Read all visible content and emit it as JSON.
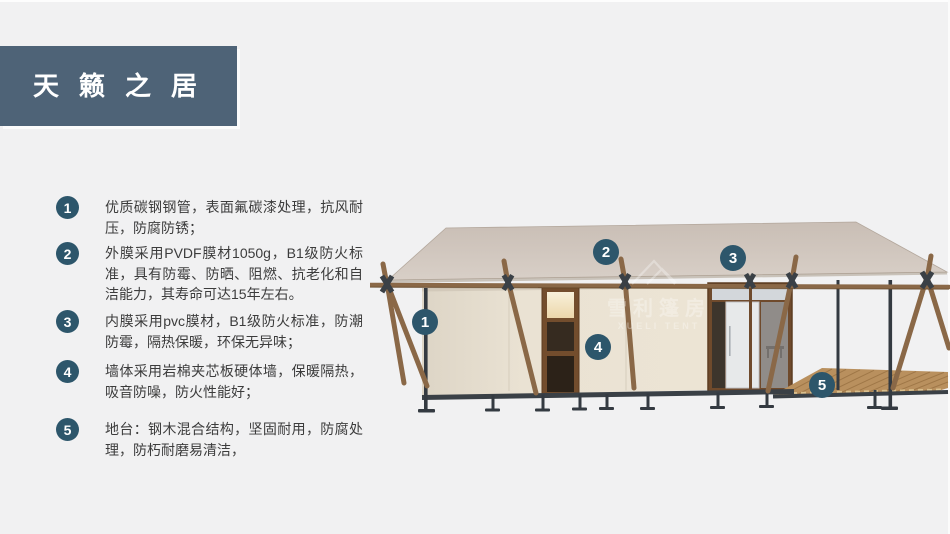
{
  "theme": {
    "background": "#f1f1f2",
    "title_block_color": "#4e6377",
    "badge_color": "#2d566b",
    "roof_color": "#cec3ba",
    "wall_color": "#e9e1d2",
    "wood_color": "#8a6847"
  },
  "header": {
    "title": "天籁之居"
  },
  "features": {
    "items": [
      {
        "number": "1",
        "text": "优质碳钢钢管，表面氟碳漆处理，抗风耐压，防腐防锈；"
      },
      {
        "number": "2",
        "text": "外膜采用PVDF膜材1050g，B1级防火标准，具有防霉、防晒、阻燃、抗老化和自洁能力，其寿命可达15年左右。"
      },
      {
        "number": "3",
        "text": "内膜采用pvc膜材，B1级防火标准，防潮防霉，隔热保暖，环保无异味；"
      },
      {
        "number": "4",
        "text": "墙体采用岩棉夹芯板硬体墙，保暖隔热，吸音防噪，防火性能好；"
      },
      {
        "number": "5",
        "text": "地台：钢木混合结构，坚固耐用，防腐处理，防朽耐磨易清洁，"
      }
    ]
  },
  "diagram": {
    "callouts": [
      "1",
      "2",
      "3",
      "4",
      "5"
    ],
    "watermark": {
      "cn": "雪利篷房",
      "en": "XUELI TENT"
    }
  }
}
